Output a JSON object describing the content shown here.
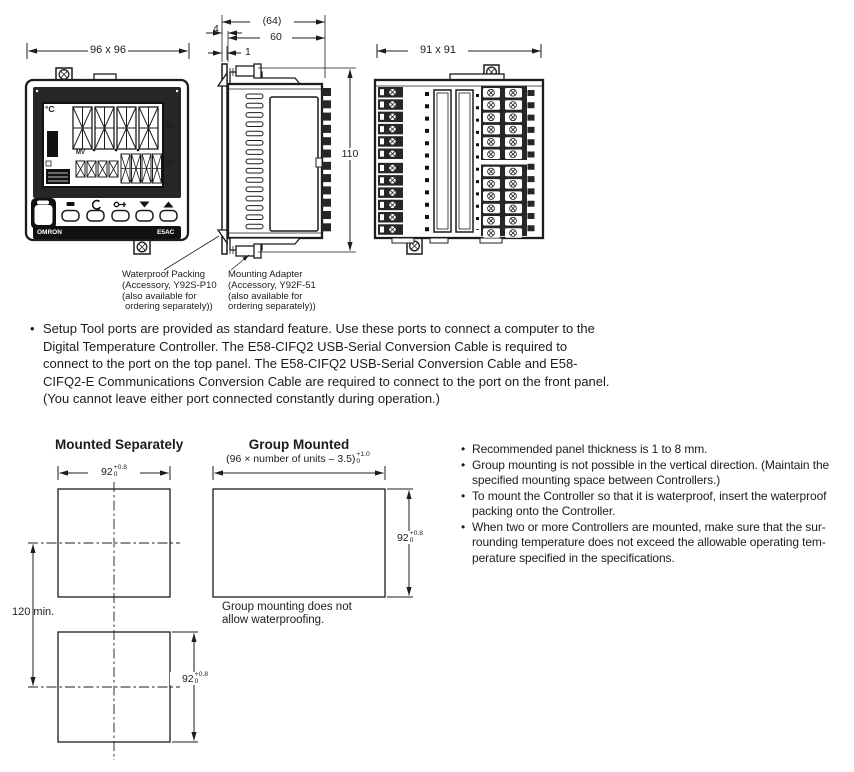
{
  "ui": {
    "bullet": "•"
  },
  "diagrams": {
    "front_view": {
      "dim_width": "96 x 96",
      "temp_unit": "°C",
      "pv_label": "PV",
      "mv_label": "MV",
      "sv_label": "SV",
      "brand": "OMRON",
      "model": "E5AC"
    },
    "side_view": {
      "dim_overall_depth": "(64)",
      "dim_bezel_depth": "4",
      "dim_body_depth": "60",
      "dim_panel_gap": "1",
      "dim_height": "110"
    },
    "rear_view": {
      "dim_width": "91 x 91"
    },
    "callouts": {
      "waterproof_packing": {
        "line1": "Waterproof Packing",
        "line2": "(Accessory, Y92S-P10",
        "line3": "(also available for",
        "line4": "ordering separately))"
      },
      "mounting_adapter": {
        "line1": "Mounting Adapter",
        "line2": "(Accessory, Y92F-51",
        "line3": "(also available for",
        "line4": "ordering separately))"
      }
    }
  },
  "setup_note": {
    "lines": [
      "Setup Tool ports are provided as standard feature. Use these ports to connect a computer to the",
      "Digital Temperature Controller. The E58-CIFQ2 USB-Serial Conversion Cable is required to",
      "connect to the port on the top panel. The E58-CIFQ2 USB-Serial Conversion Cable and E58-",
      "CIFQ2-E Communications Conversion Cable are required to connect to the port on the front panel.",
      "(You cannot leave either port connected constantly during operation.)"
    ]
  },
  "mounting": {
    "separate": {
      "title": "Mounted Separately",
      "cutout_width": {
        "base": "92",
        "sup": "+0.8",
        "sub": "0"
      },
      "cutout_height": {
        "base": "92",
        "sup": "+0.8",
        "sub": "0"
      },
      "min_spacing": "120 min."
    },
    "group": {
      "title": "Group Mounted",
      "cutout_width": {
        "base": "(96 × number of units – 3.5)",
        "sup": "+1.0",
        "sub": "0"
      },
      "cutout_height": {
        "base": "92",
        "sup": "+0.8",
        "sub": "0"
      },
      "caption_line1": "Group mounting does not",
      "caption_line2": "allow waterproofing."
    },
    "notes": [
      {
        "lines": [
          "Recommended panel thickness is 1 to 8 mm."
        ]
      },
      {
        "lines": [
          "Group mounting is not possible in the vertical direction. (Maintain the",
          "specified mounting space between Controllers.)"
        ]
      },
      {
        "lines": [
          "To mount the Controller so that it is waterproof, insert the waterproof",
          "packing onto the Controller."
        ]
      },
      {
        "lines": [
          "When two or more Controllers are mounted, make sure that the sur-",
          "rounding temperature does not exceed the allowable operating tem-",
          "perature specified in the specifications."
        ]
      }
    ]
  },
  "colors": {
    "line": "#1c1c1c",
    "panel_dark": "#262626",
    "background": "#ffffff"
  }
}
